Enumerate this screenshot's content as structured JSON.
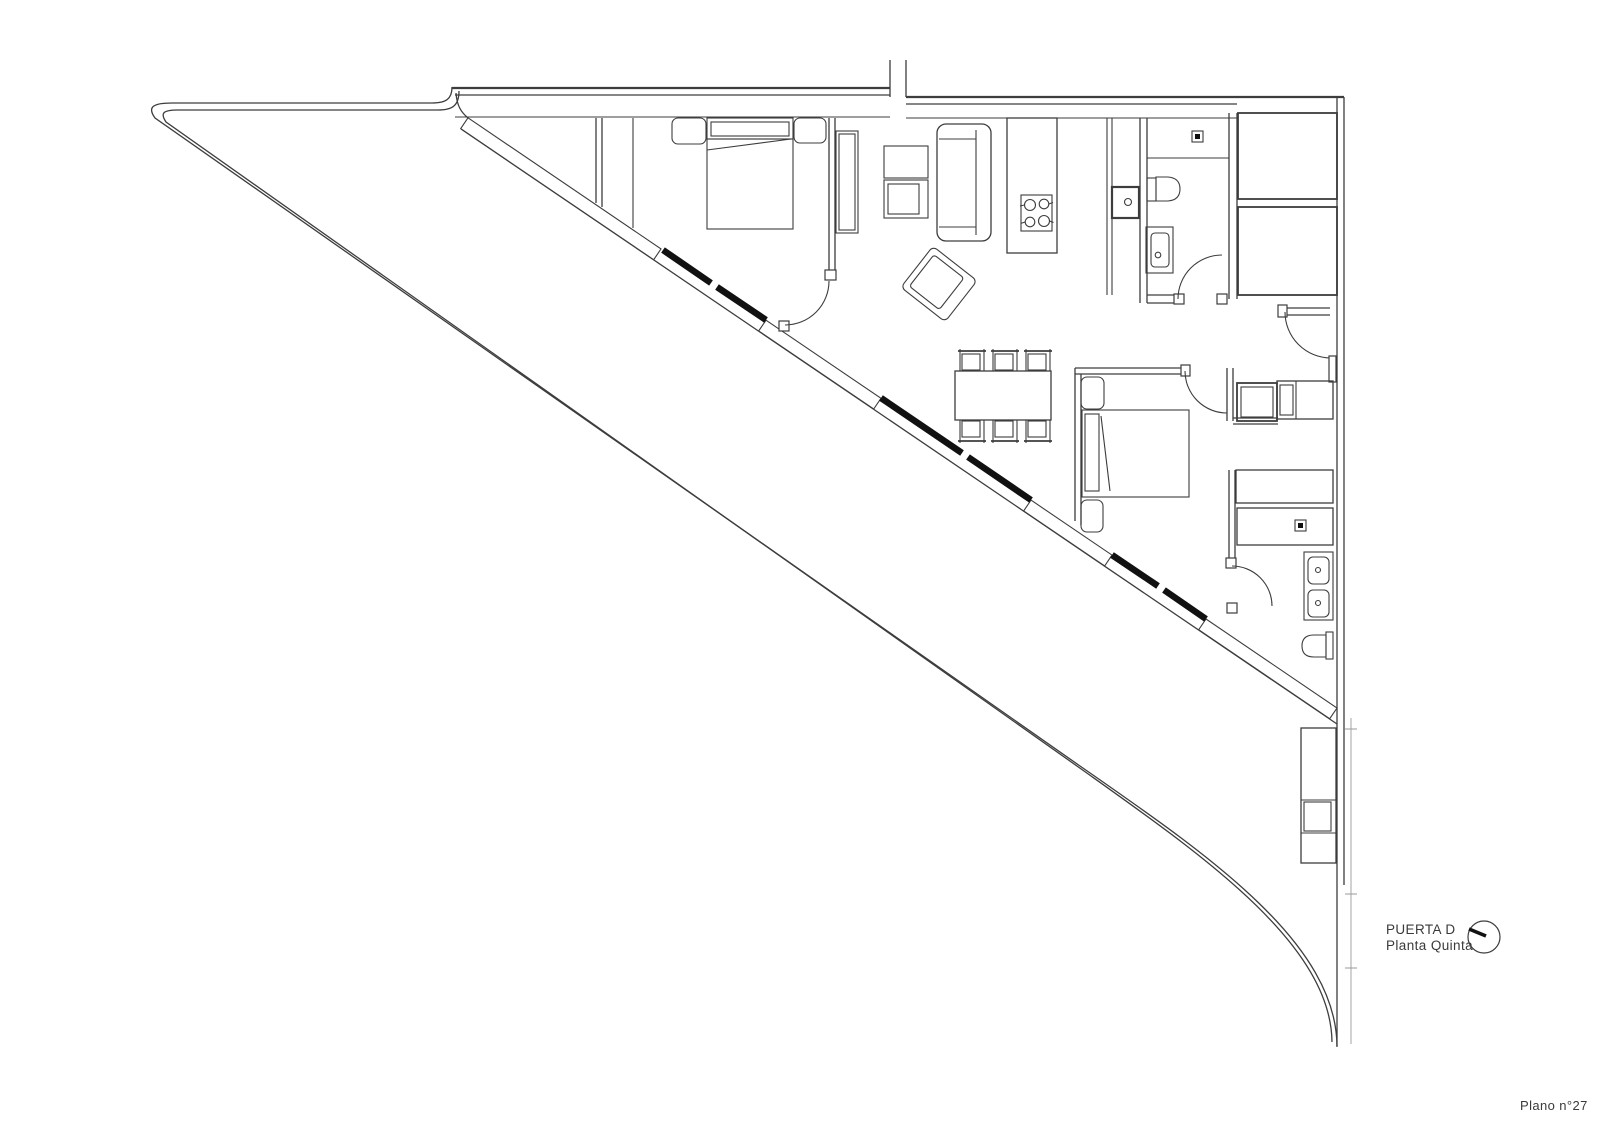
{
  "labels": {
    "door": "PUERTA D",
    "floor": "Planta Quinta",
    "sheet": "Plano n°27"
  },
  "icons": {
    "orientation_dial": "circle-with-needle-icon"
  },
  "colors": {
    "background": "#ffffff",
    "line": "#3d3d3d",
    "window_glazing": "#111111",
    "construction_line": "#9a9a9a"
  }
}
